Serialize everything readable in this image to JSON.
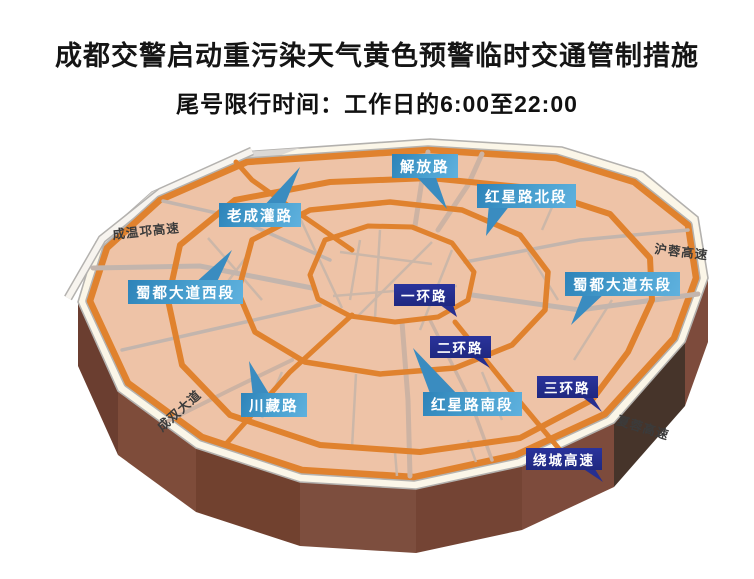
{
  "title": "成都交警启动重污染天气黄色预警临时交通管制措施",
  "subtitle": "尾号限行时间：工作日的6:00至22:00",
  "map": {
    "callouts": {
      "jiefang": "解放路",
      "hongxing_north": "红星路北段",
      "laochengguan": "老成灌路",
      "shudu_west": "蜀都大道西段",
      "shudu_east": "蜀都大道东段",
      "yihuan": "一环路",
      "erhuan": "二环路",
      "sanhuan": "三环路",
      "hongxing_south": "红星路南段",
      "chuanzang": "川藏路",
      "raocheng": "绕城高速"
    },
    "road_texts": {
      "chengwenqiong": "成温邛高速",
      "hurong": "沪蓉高速",
      "xiarong": "夏蓉高速",
      "chengshuang": "成双大道"
    },
    "colors": {
      "surface": "#EEC3A7",
      "ring_orange": "#E0822E",
      "rim_white": "#FBF6E8",
      "side_brown": "#7C4A3B",
      "side_dark": "#46342A",
      "callout_blue": "#3D95C9",
      "callout_navy": "#232C8C"
    }
  }
}
